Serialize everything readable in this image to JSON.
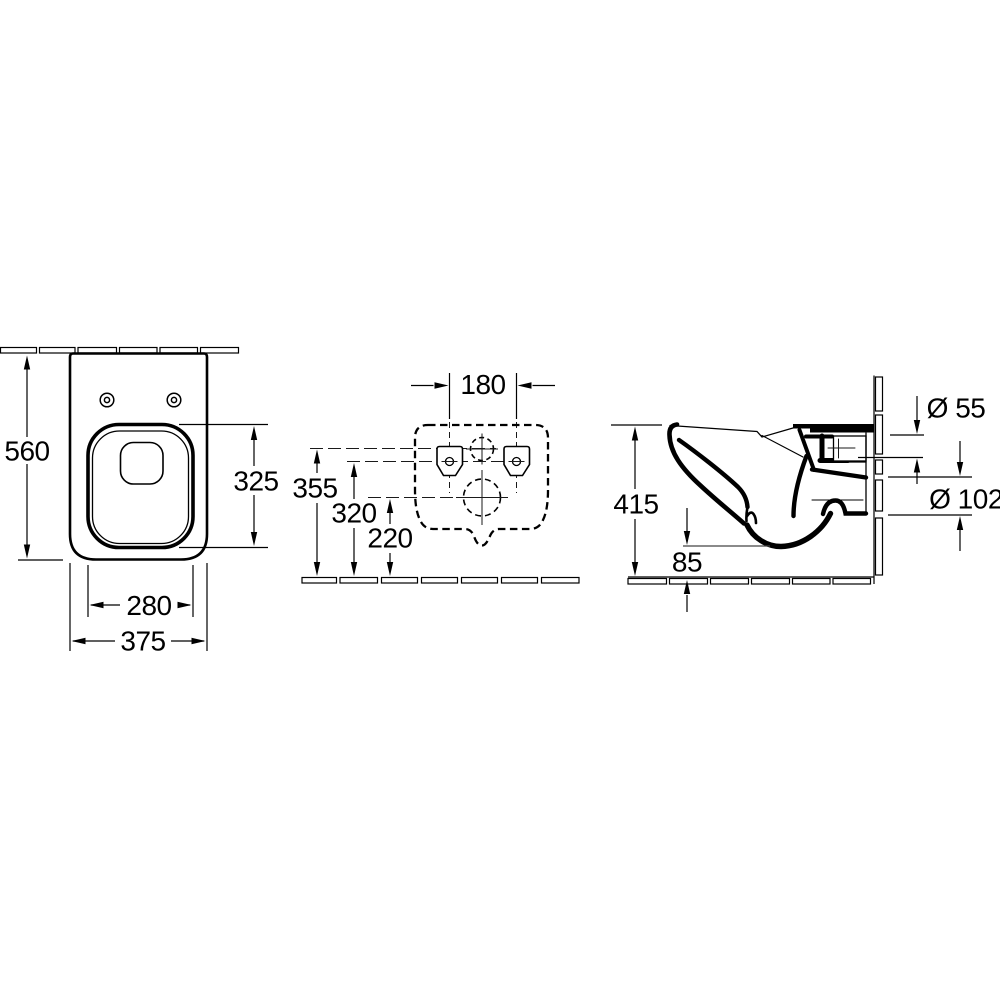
{
  "drawing": {
    "title": "Wall-hung WC installation dimension drawing",
    "line_color": "#000000",
    "background_color": "#ffffff",
    "views": {
      "top": {
        "dims": {
          "depth": "560",
          "seat_opening_length": "325",
          "inner_width": "280",
          "outer_width": "375"
        }
      },
      "rear": {
        "dims": {
          "fixing_hole_spacing": "180",
          "inlet_center_height": "355",
          "fixing_hole_height": "320",
          "outlet_center_height": "220"
        }
      },
      "side": {
        "dims": {
          "total_height": "415",
          "underside_clearance": "85",
          "inlet_diameter": "Ø 55",
          "outlet_diameter": "Ø 102"
        }
      }
    }
  }
}
